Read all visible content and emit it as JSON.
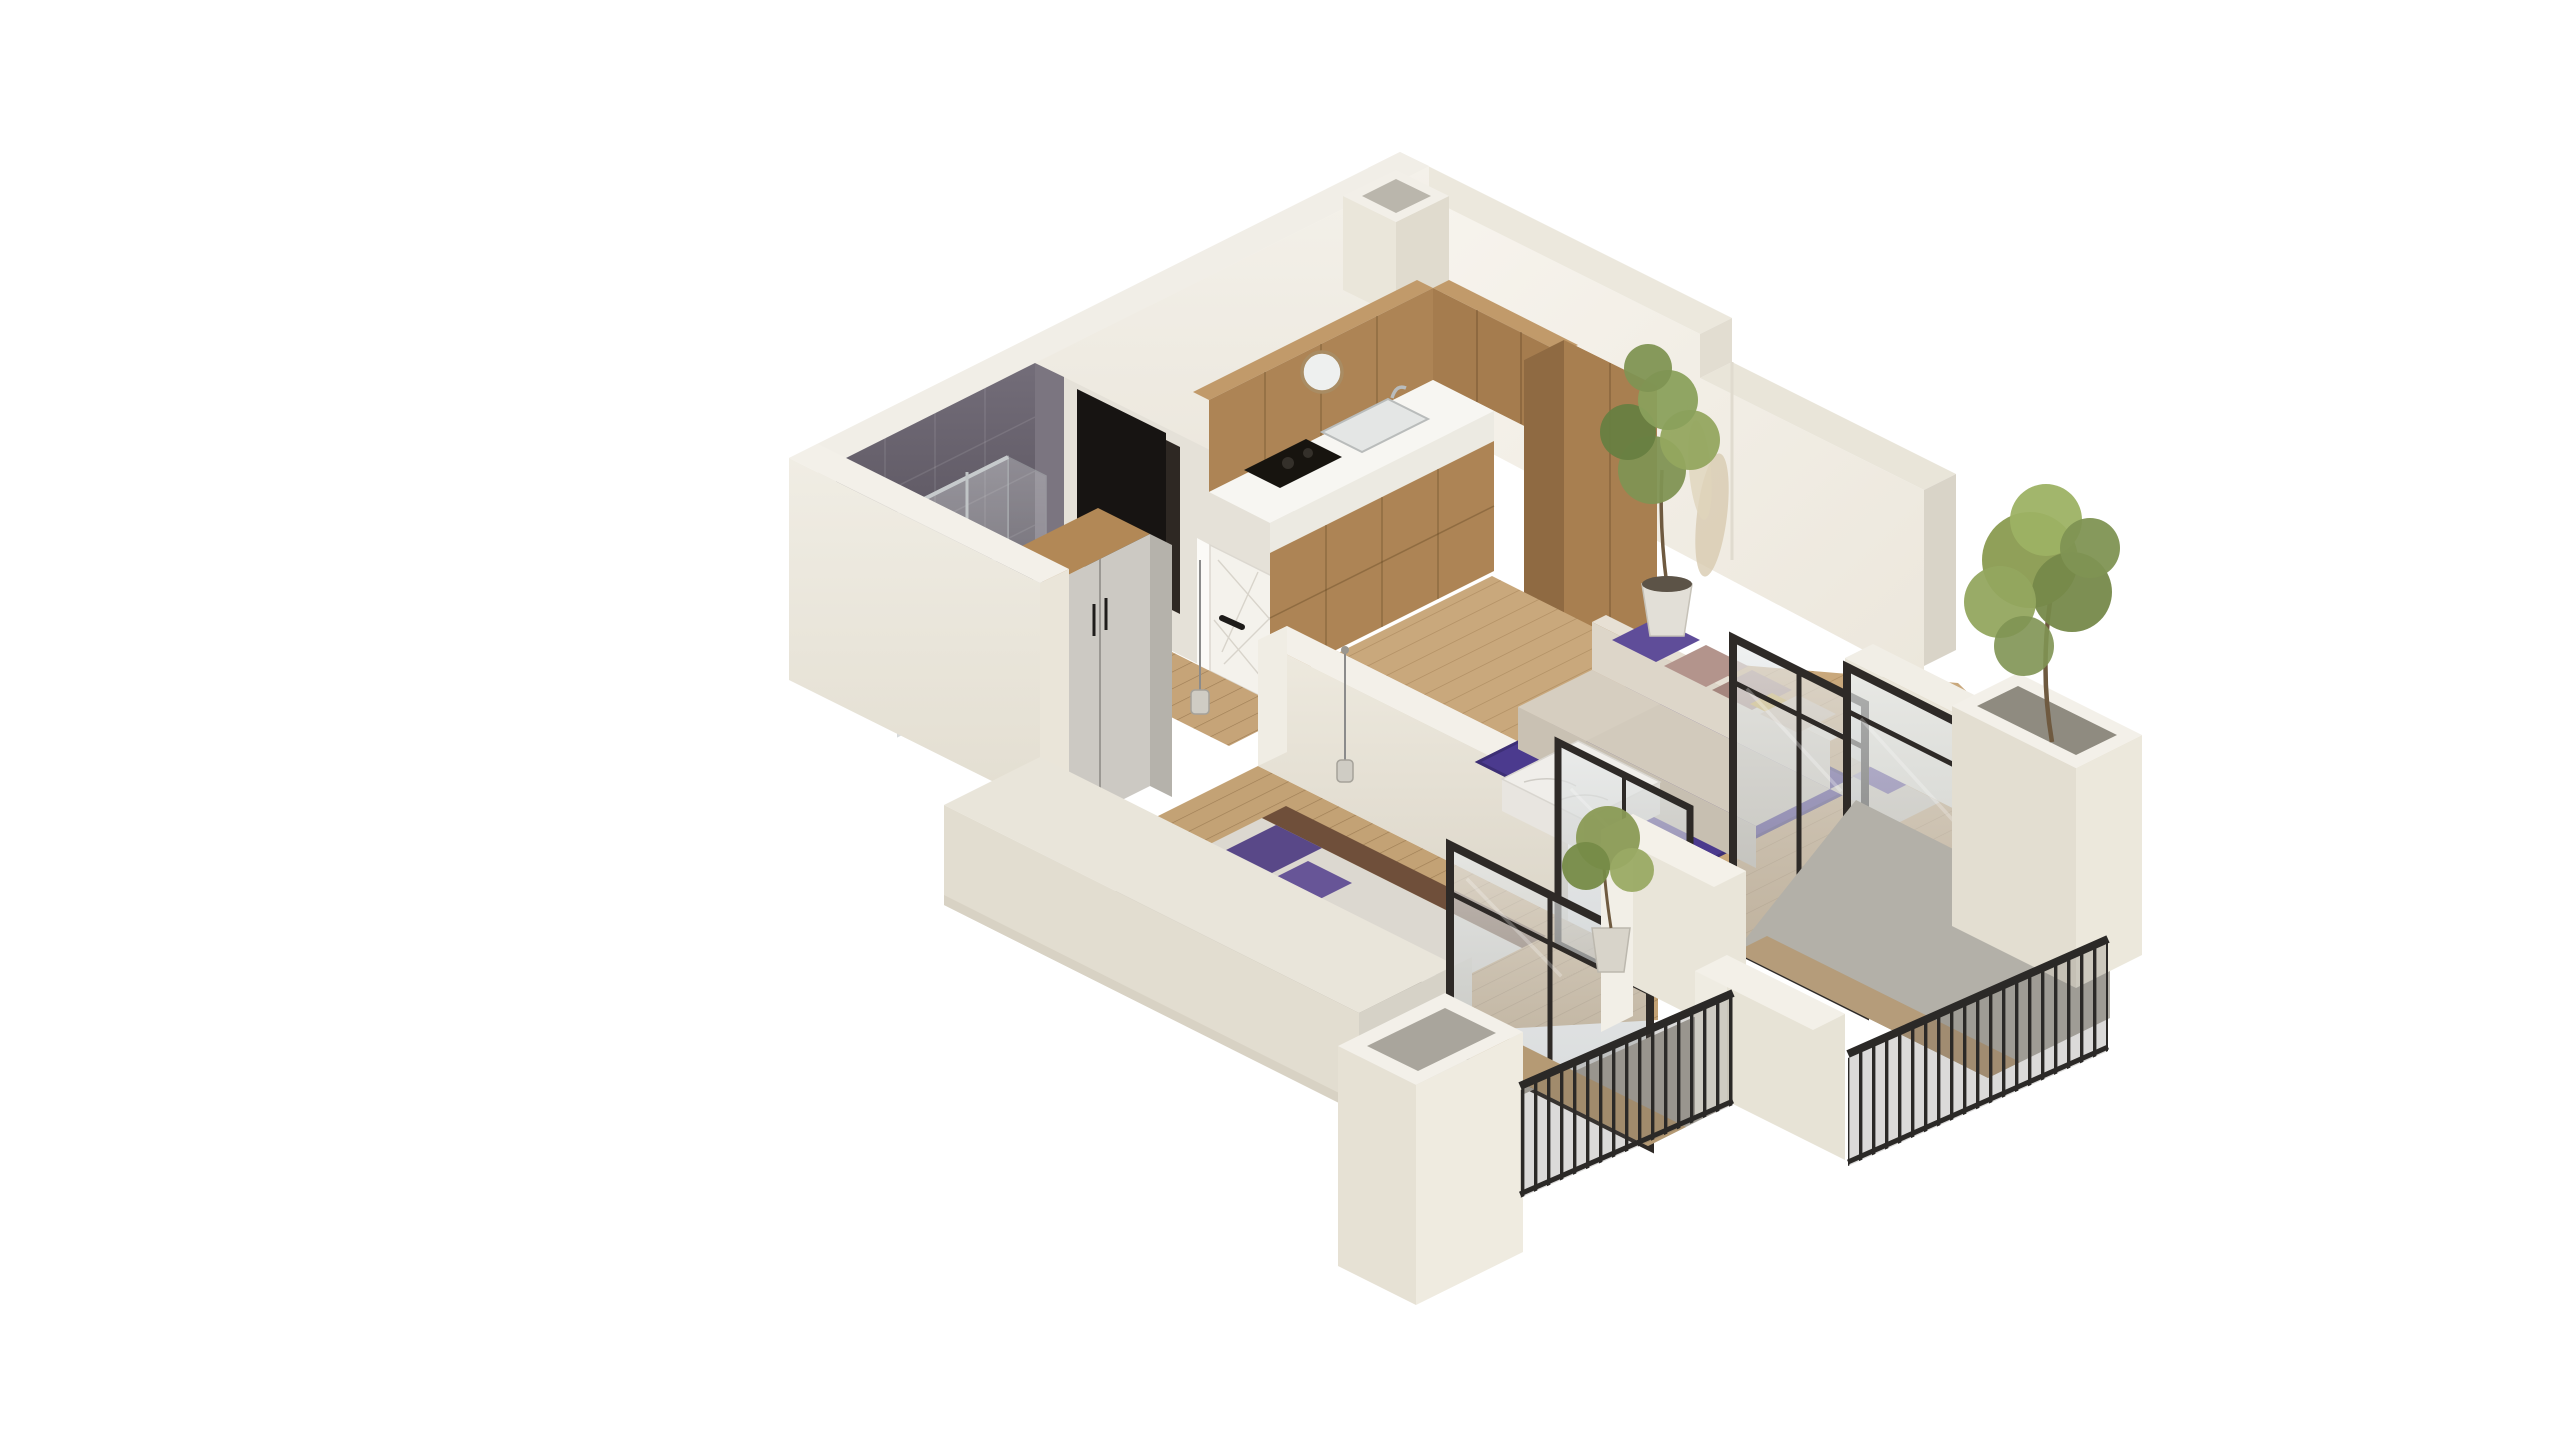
{
  "scene": {
    "title": "Isometric 3D cutaway render of a one-bedroom apartment floor plan",
    "description": "Bird's-eye axonometric render on a white background: cream cutaway walls, bathroom with dark slate tiles and glass shower, entry hall with white panelled door and dark open doorway, L-shaped oak kitchen with white countertop, living room with beige corner sofa, purple rug and marble coffee table, bedroom with grey bed and purple pillows, wardrobe, and two balconies with black metal railings, white planter boxes and potted trees behind black-framed glass sliding doors.",
    "background_color": "#ffffff"
  },
  "palette": {
    "wall_top": "#f2efe8",
    "wall_cream_face": "#eae6db",
    "wall_white_face": "#f6f3ed",
    "wall_shadow": "#ddd8cc",
    "tile_slate_dark": "#544e5b",
    "tile_slate_light": "#6e6873",
    "wood_cabinet_light": "#c19a6a",
    "wood_cabinet_mid": "#ad8455",
    "wood_cabinet_dark": "#8f6a42",
    "countertop_white": "#f7f6f2",
    "cooktop_black": "#17140f",
    "wood_floor": "#c9a87c",
    "wood_floor_bedroom": "#c3a275",
    "rug_purple": "#4b3a8e",
    "pillow_purple": "#5f4d99",
    "pillow_mauve": "#b3948c",
    "pillow_beige": "#cfbda8",
    "pillow_ochre": "#c9a33c",
    "sofa_beige": "#d2cabc",
    "marble_table": "#efedea",
    "bed_blanket_grey": "#a8a39a",
    "bed_headboard_wood": "#6f4f3a",
    "wardrobe_door_grey": "#ccc9c3",
    "entry_door_white": "#f4f2ec",
    "open_doorway_black": "#171412",
    "glass_frame_black": "#2e2a27",
    "railing_black": "#2b2927",
    "balcony_floor_grey": "#b3b0a8",
    "balcony_floor_wood": "#b59a74",
    "parapet_white": "#e9e5d9",
    "plant_green": "#7f9453",
    "pampas_beige": "#d8cbb0",
    "pot_white": "#dcd8cf"
  },
  "rooms": [
    {
      "name": "bathroom",
      "features": [
        "dark slate tiled walls",
        "glass shower enclosure with chrome bars",
        "toilet"
      ]
    },
    {
      "name": "entry-hall",
      "features": [
        "white entry door with decorative panel lines and black handle",
        "dark open doorway",
        "pendant lamp",
        "wood floor"
      ]
    },
    {
      "name": "kitchen",
      "features": [
        "L-shaped oak upper and lower cabinets",
        "tall oak cabinet column",
        "white countertop",
        "sink with faucet",
        "black cooktop",
        "round wall mirror"
      ]
    },
    {
      "name": "living-room",
      "features": [
        "L-shaped beige corner sofa",
        "purple, mauve and beige cushions",
        "deep purple area rug",
        "white marble coffee table",
        "tall potted plant",
        "pampas grass"
      ]
    },
    {
      "name": "bedroom",
      "features": [
        "double bed with grey blanket and white sheet fold",
        "two purple pillows",
        "dark wood headboard band",
        "wardrobe with oak top and grey doors",
        "pendant lamp",
        "small sphere lamp"
      ]
    },
    {
      "name": "balconies",
      "features": [
        "black-framed glass sliding doors",
        "black metal balustrades",
        "white parapet piers",
        "two white planter boxes",
        "potted tree",
        "potted shrub",
        "grey and wood-look decking"
      ]
    }
  ],
  "structure": {
    "walls": [
      "north-west cutaway wall",
      "north-east cutaway wall",
      "south-west cream wall with ledge step",
      "interior partition between living room and bedroom",
      "hall wall with open doorway"
    ],
    "roof_duct": "small square shaft at north corner",
    "view": "axonometric bird's-eye from the south"
  },
  "counts": {
    "glass_door_panels": 4,
    "railing_segments": 2,
    "planter_boxes": 2,
    "indoor_plants": 2,
    "balcony_plants": 2,
    "pendant_lamps": 2,
    "sofa_cushions": 6,
    "bed_pillows": 2
  }
}
